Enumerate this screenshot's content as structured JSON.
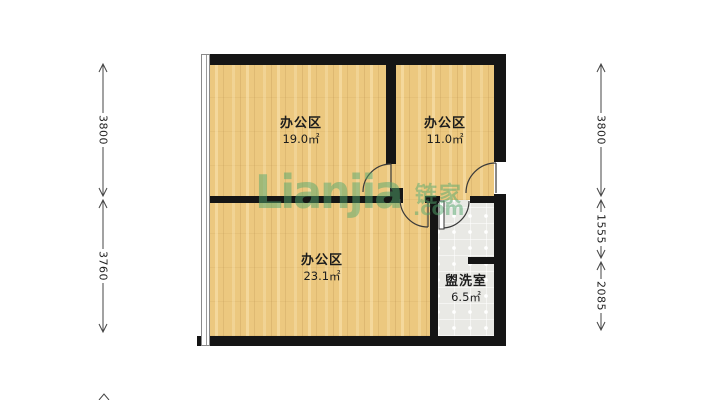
{
  "floorplan": {
    "rooms": [
      {
        "name": "办公区",
        "area": "19.0㎡"
      },
      {
        "name": "办公区",
        "area": "11.0㎡"
      },
      {
        "name": "办公区",
        "area": "23.1㎡"
      },
      {
        "name": "盥洗室",
        "area": "6.5㎡"
      }
    ],
    "dimensions": {
      "left": [
        {
          "label": "3800"
        },
        {
          "label": "3760"
        }
      ],
      "right": [
        {
          "label": "3800"
        },
        {
          "label": "1555"
        },
        {
          "label": "2085"
        }
      ]
    },
    "watermark": {
      "brand": "Lianjia",
      "cn": "链家",
      "suffix": ".com"
    },
    "colors": {
      "wall": "#151515",
      "wood_floor": "#ecc87f",
      "tile_floor": "#e9e9e5",
      "watermark_green": "#54a86e",
      "dimension_text": "#222222"
    }
  }
}
